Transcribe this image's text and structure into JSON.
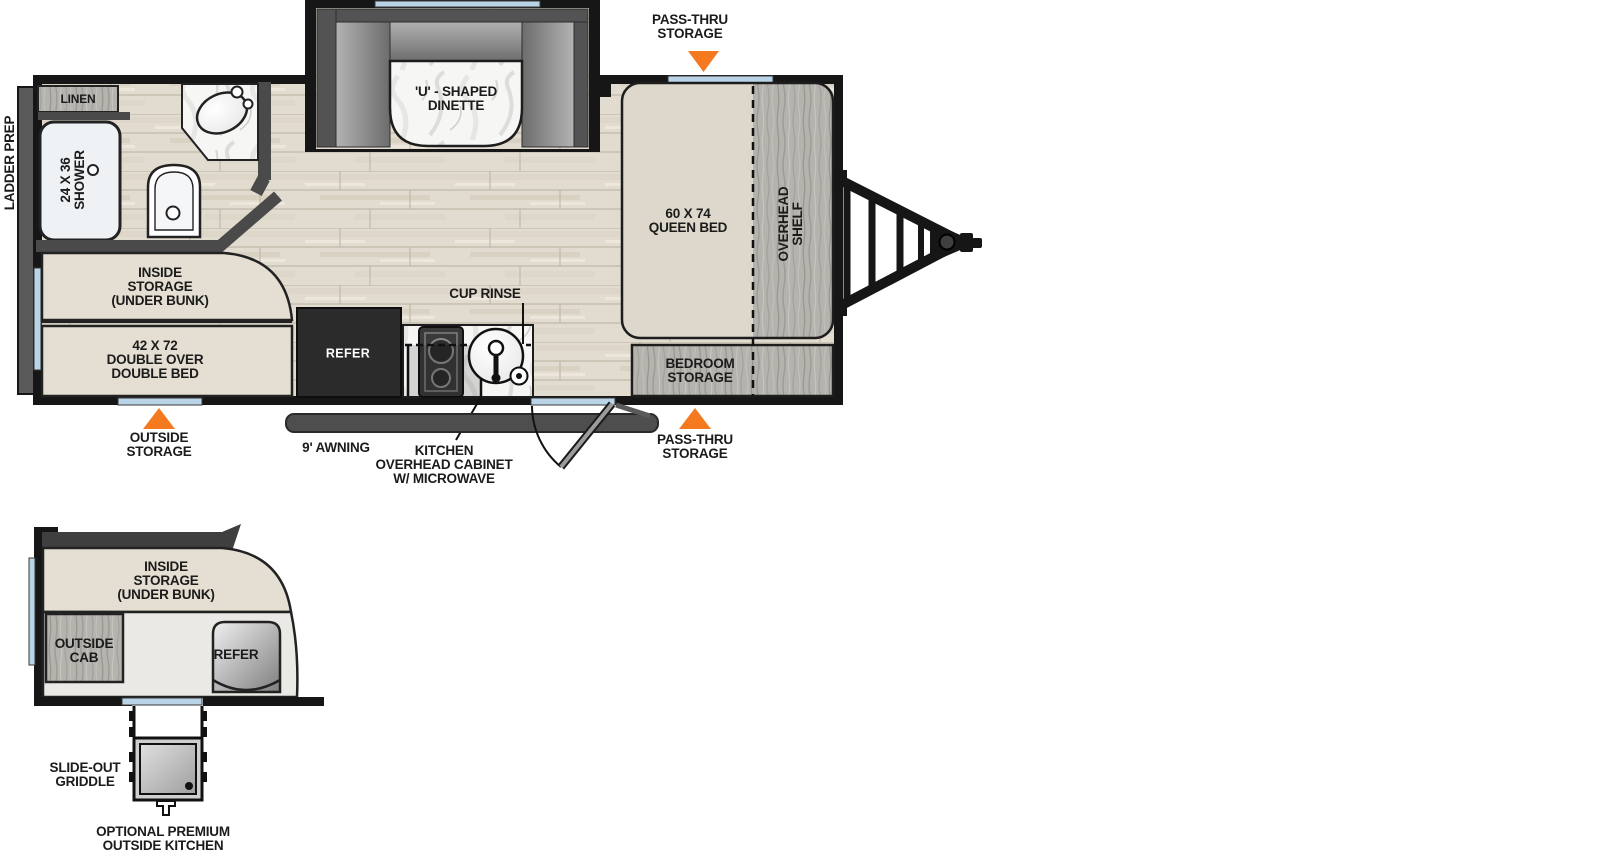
{
  "title": "Travel trailer floor plan with optional outside kitchen",
  "colors": {
    "wall": "#161616",
    "inner_wall": "#4a4a4a",
    "accent_orange": "#f4791f",
    "window_blue": "#b9d4e6",
    "floor_wood": "#e2dcd0",
    "bed_beige": "#ddd8cb",
    "storage_wood_gray": "#b5b3ae",
    "awning_gray": "#4e4e4e",
    "refer_dark": "#2b2b2b"
  },
  "main_plan": {
    "labels": {
      "ladder_prep": "LADDER PREP",
      "linen": "LINEN",
      "shower": "24 X 36\nSHOWER",
      "dinette": "'U' - SHAPED\nDINETTE",
      "pass_thru_top": "PASS-THRU\nSTORAGE",
      "queen_bed": "60 X 74\nQUEEN BED",
      "overhead_shelf": "OVERHEAD\nSHELF",
      "inside_storage": "INSIDE\nSTORAGE\n(UNDER BUNK)",
      "double_bed": "42 X 72\nDOUBLE OVER\nDOUBLE BED",
      "outside_storage": "OUTSIDE\nSTORAGE",
      "awning": "9' AWNING",
      "refer": "REFER",
      "cup_rinse": "CUP RINSE",
      "kitchen_cabinet": "KITCHEN\nOVERHEAD CABINET\nW/ MICROWAVE",
      "bedroom_storage": "BEDROOM\nSTORAGE",
      "pass_thru_bottom": "PASS-THRU\nSTORAGE"
    }
  },
  "outside_kitchen_plan": {
    "labels": {
      "inside_storage": "INSIDE\nSTORAGE\n(UNDER BUNK)",
      "outside_cab": "OUTSIDE\nCAB",
      "refer": "REFER",
      "slide_out_griddle": "SLIDE-OUT\nGRIDDLE",
      "optional_outside_kitchen": "OPTIONAL PREMIUM\nOUTSIDE KITCHEN"
    }
  }
}
